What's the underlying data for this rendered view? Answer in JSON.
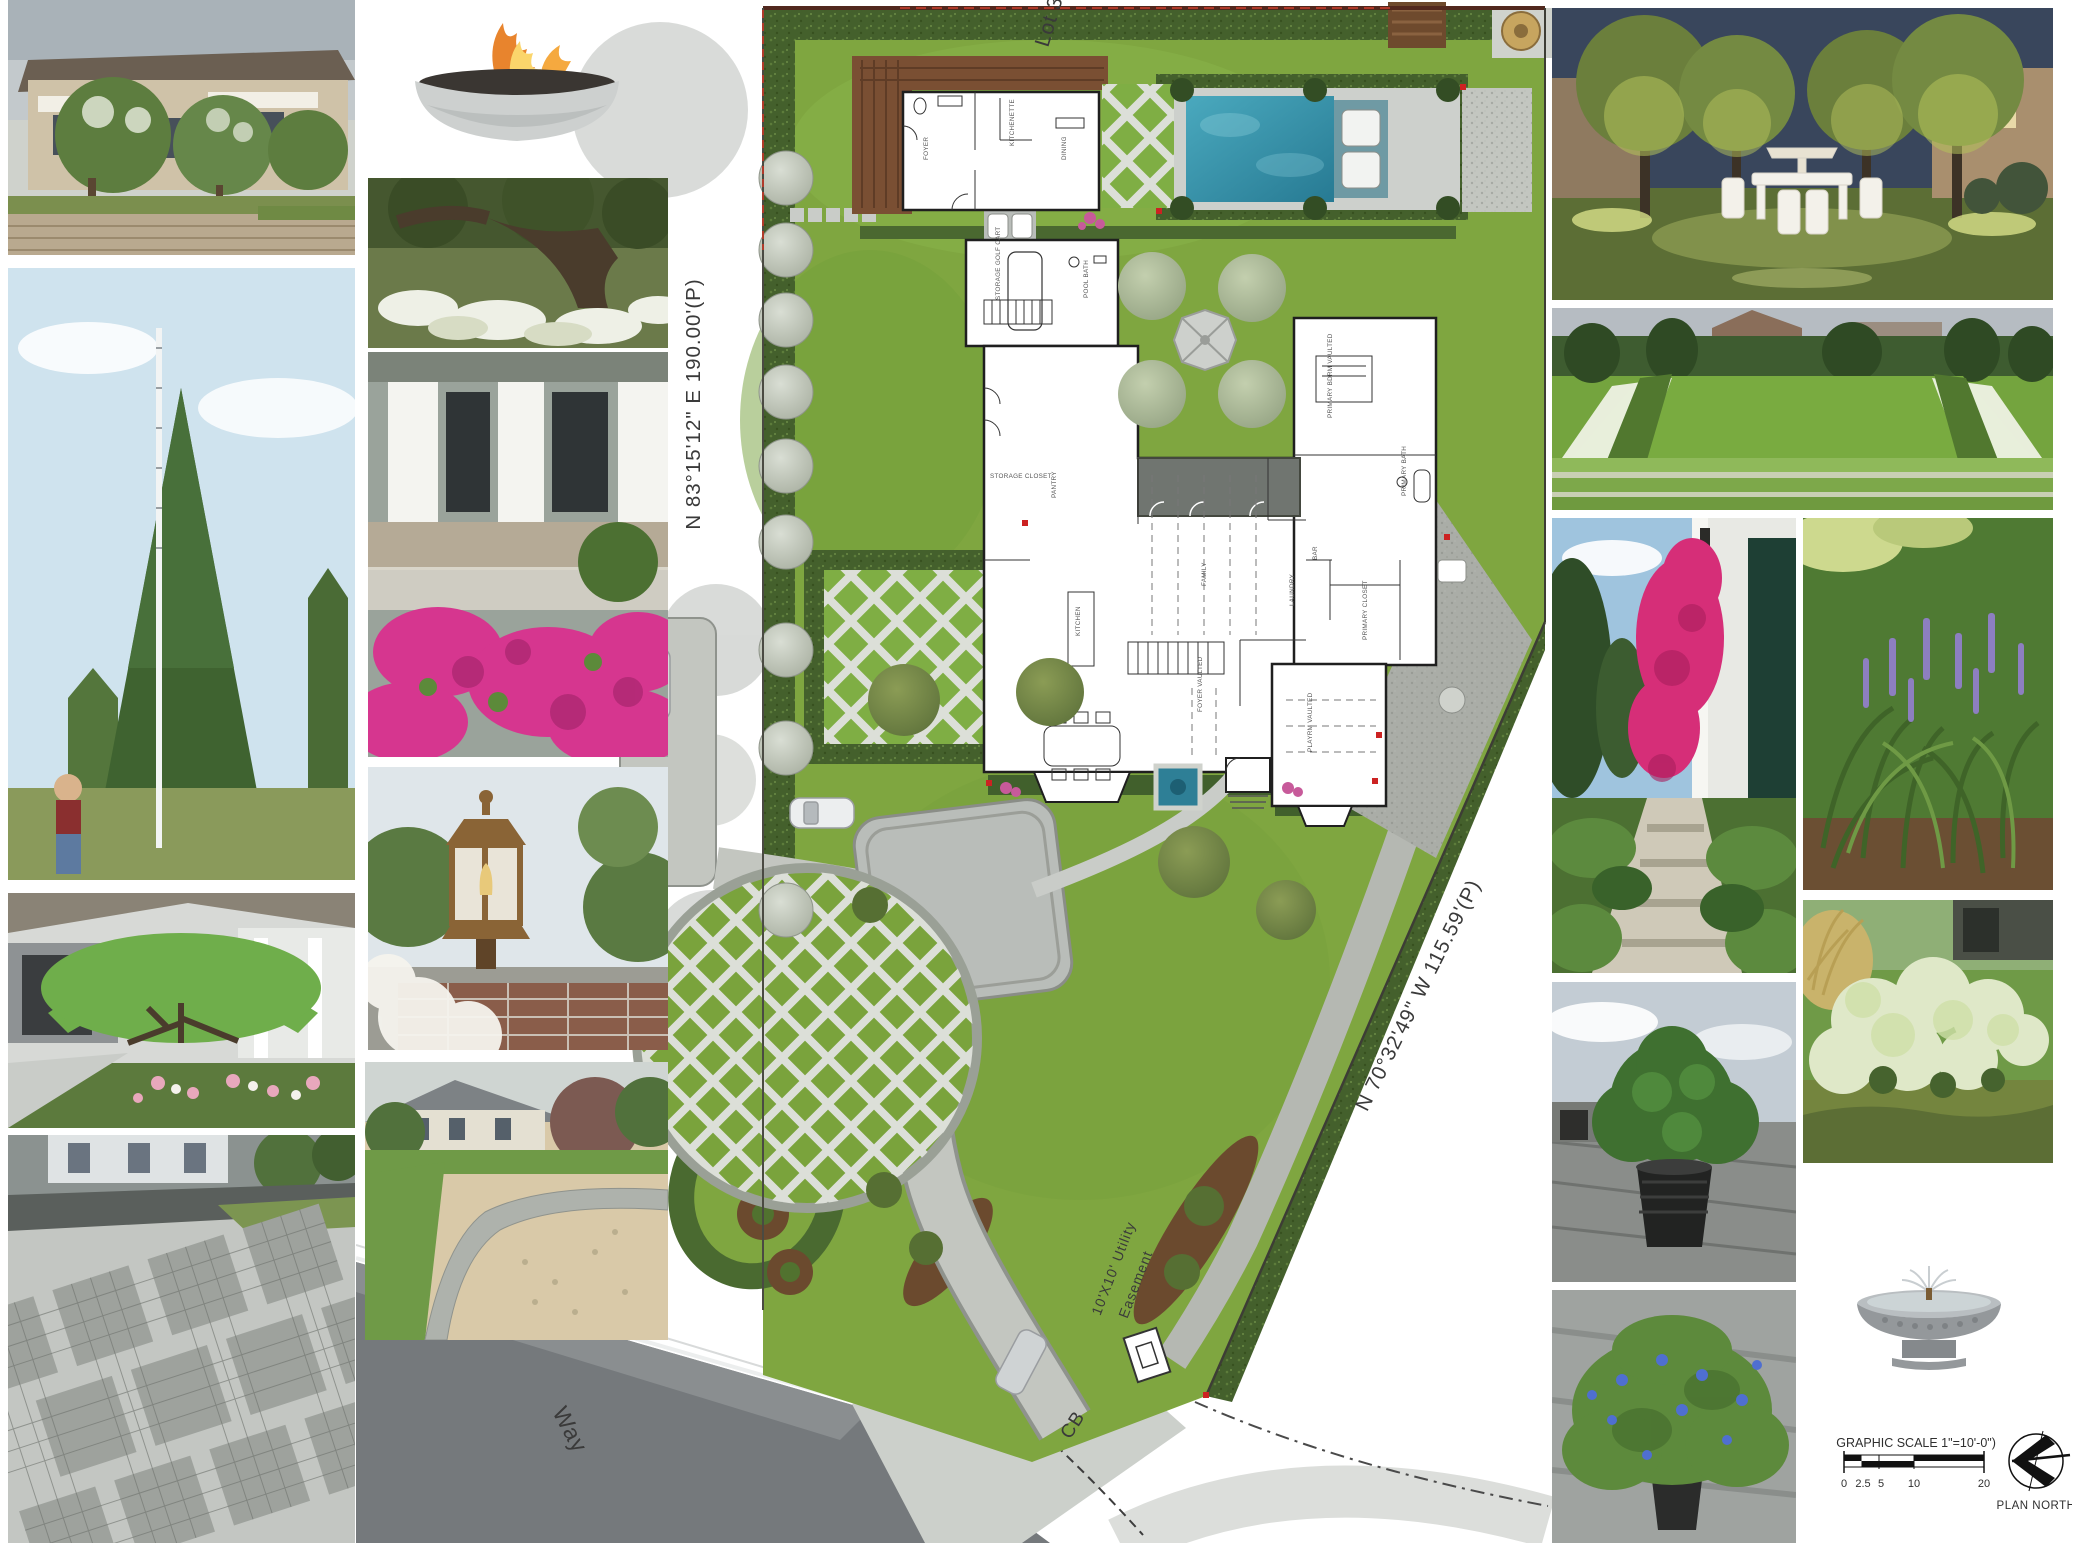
{
  "plan": {
    "lot_label": "Lot 32",
    "west_boundary_bearing": "N 83°15'12\" E   190.00'(P)",
    "southeast_boundary_bearing": "N 70°32'49\" W   115.59'(P)",
    "easement_label_line1": "10'X10' Utility",
    "easement_label_line2": "Easement",
    "street_label": "Way",
    "catch_basin_label": "CB",
    "rooms": {
      "guest_foyer": "FOYER",
      "kitchenette": "KITCHENETTE",
      "dining": "DINING",
      "storage_golf_cart": "STORAGE GOLF CART",
      "pool_bath": "POOL BATH",
      "storage_closet": "STORAGE CLOSET",
      "pantry": "PANTRY",
      "kitchen": "KITCHEN",
      "family": "FAMILY",
      "bar": "BAR",
      "laundry": "LAUNDRY",
      "primary_closet": "PRIMARY CLOSET",
      "primary_bath": "PRIMARY BATH",
      "primary_bedroom": "PRIMARY BDRM VAULTED",
      "foyer_vaulted": "FOYER VAULTED",
      "playroom": "PLAYRM VAULTED"
    },
    "colors": {
      "lawn": "#7fa640",
      "hedge": "#44602c",
      "pool_water": "#2e7f96",
      "hardscape": "#c3c6c0",
      "deck": "#7a4f33",
      "marker_red": "#cc2222"
    }
  },
  "legend": {
    "graphic_scale_label": "(GRAPHIC SCALE 1\"=10'-0\")",
    "scale_ticks": [
      "0",
      "2.5",
      "5",
      "10",
      "20"
    ],
    "plan_north_label": "PLAN NORTH"
  },
  "photos": [
    {
      "id": "house-crape-myrtle",
      "depicts": "Two-story stucco house with crape myrtles over a brick garden wall"
    },
    {
      "id": "specimen-evergreen",
      "depicts": "Nurseryman measuring a tall conical evergreen with a pole"
    },
    {
      "id": "dome-pruned-tree",
      "depicts": "Umbrella-pruned evergreen over a pink flower bed by a porch"
    },
    {
      "id": "cobble-grid-driveway",
      "depicts": "Granite cobble driveway laid in a diagonal grid"
    },
    {
      "id": "fire-bowl",
      "depicts": "Round concrete gas fire bowl"
    },
    {
      "id": "live-oak-azaleas",
      "depicts": "Live oak underplanted with white azaleas"
    },
    {
      "id": "porch-azaleas",
      "depicts": "Front porch steps with hot-pink azaleas and topiary"
    },
    {
      "id": "gas-lantern",
      "depicts": "Copper gas lantern on a brick pier"
    },
    {
      "id": "pea-gravel-court",
      "depicts": "Pea-gravel motor court with cobble edging"
    },
    {
      "id": "evening-garden",
      "depicts": "Uplit allee of trees over a white garden dining set at dusk"
    },
    {
      "id": "formal-lawn",
      "depicts": "Formal lawn panel with white flower borders and grass steps"
    },
    {
      "id": "bougainvillea-path",
      "depicts": "Stone garden path with fuchsia bougainvillea and dark shutters"
    },
    {
      "id": "liriope",
      "depicts": "Liriope muscari in purple bloom"
    },
    {
      "id": "limelight-hydrangea",
      "depicts": "Limelight hydrangea border"
    },
    {
      "id": "laurel-container",
      "depicts": "Laurel shrub in a black nursery container"
    },
    {
      "id": "plumbago-container",
      "depicts": "Blue plumbago in a nursery container"
    },
    {
      "id": "fountain-bowl",
      "depicts": "Precast round fountain bowl with center jet"
    }
  ]
}
